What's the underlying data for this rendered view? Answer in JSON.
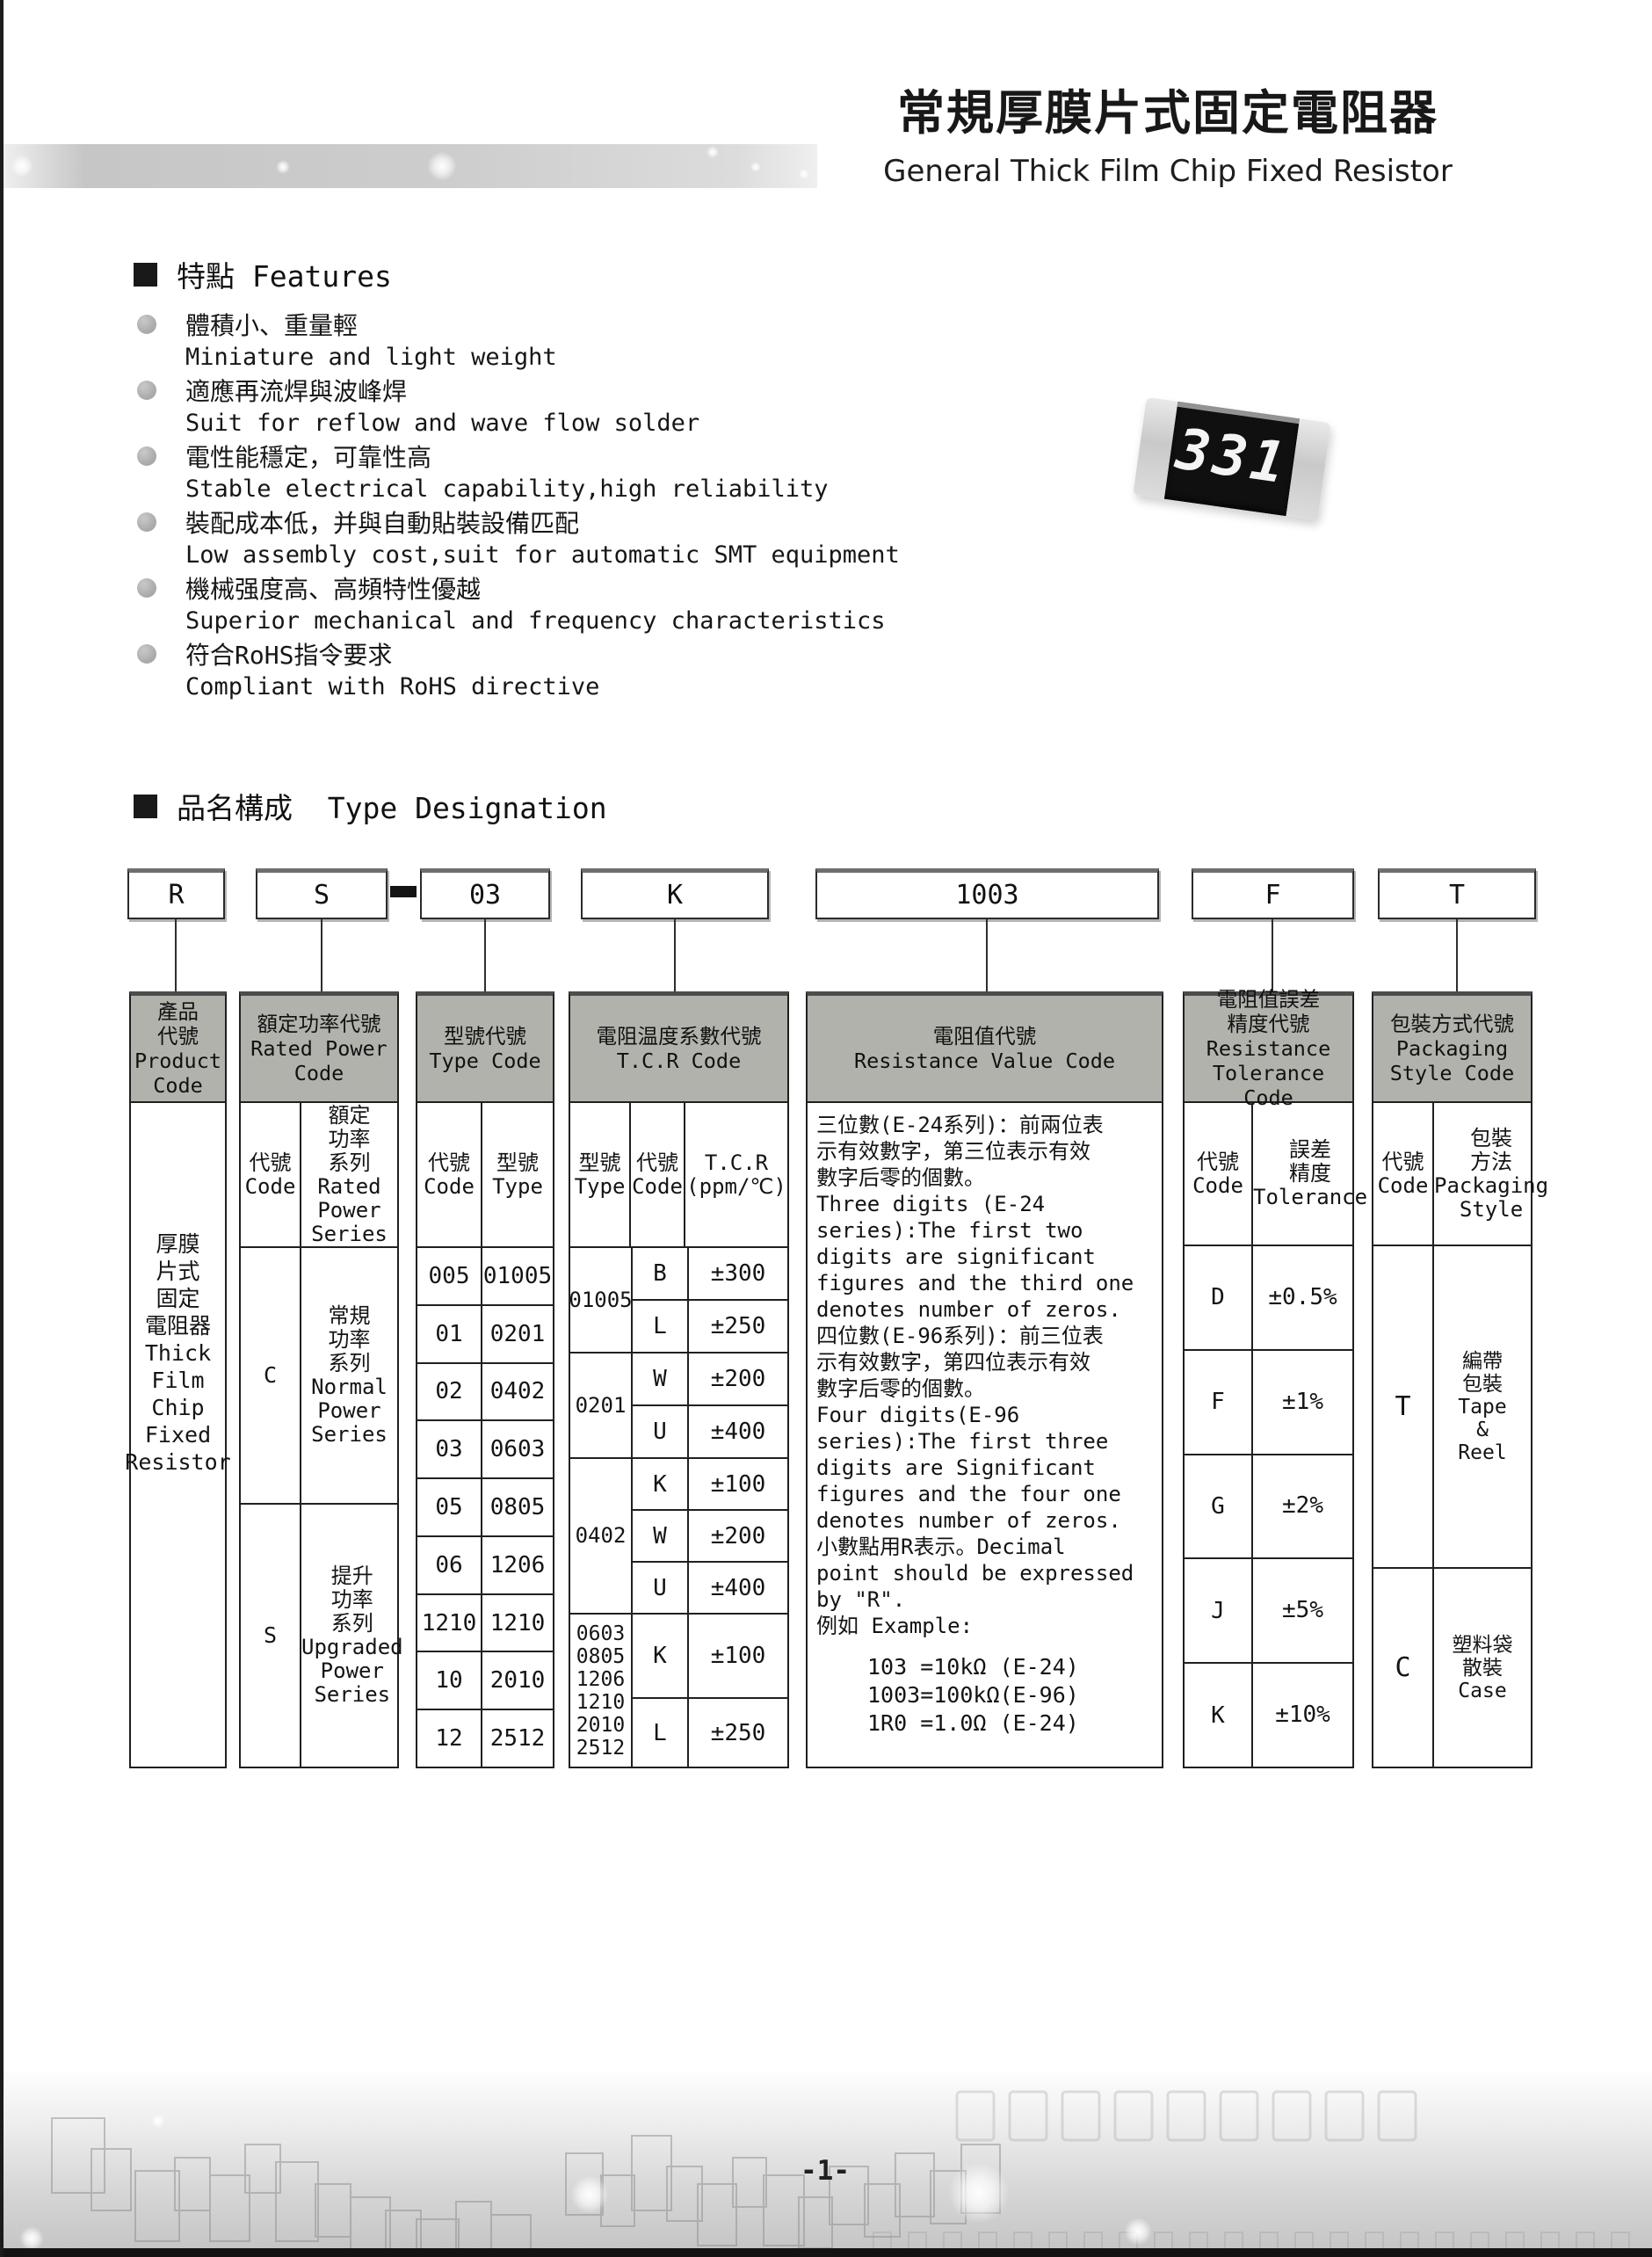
{
  "header": {
    "title_zh": "常規厚膜片式固定電阻器",
    "title_en": "General Thick Film Chip Fixed Resistor"
  },
  "features": {
    "heading": "特點 Features",
    "items": [
      {
        "zh": "體積小、重量輕",
        "en": "Miniature and light weight"
      },
      {
        "zh": "適應再流焊與波峰焊",
        "en": "Suit for reflow and wave flow solder"
      },
      {
        "zh": "電性能穩定，可靠性高",
        "en": "Stable electrical capability,high reliability"
      },
      {
        "zh": "裝配成本低，并與自動貼裝設備匹配",
        "en": "Low assembly cost,suit for automatic SMT equipment"
      },
      {
        "zh": "機械强度高、高頻特性優越",
        "en": "Superior mechanical and frequency characteristics"
      },
      {
        "zh": "符合RoHS指令要求",
        "en": "Compliant with RoHS directive"
      }
    ]
  },
  "resistor": {
    "marking": "331"
  },
  "type_designation": {
    "heading": "品名構成  Type Designation",
    "codes": {
      "product": "R",
      "power": "S",
      "type": "03",
      "tcr": "K",
      "resistance": "1003",
      "tolerance": "F",
      "packaging": "T"
    }
  },
  "table": {
    "product": {
      "header": "產品\n代號\nProduct\nCode",
      "body": "厚膜\n片式\n固定\n電阻器\nThick\nFilm\nChip\nFixed\nResistor"
    },
    "power": {
      "header": "額定功率代號\nRated Power\nCode",
      "col_code": "代號\nCode",
      "col_series": "額定\n功率\n系列\nRated\nPower\nSeries",
      "rows": [
        {
          "code": "C",
          "series": "常規\n功率\n系列\nNormal\nPower\nSeries"
        },
        {
          "code": "S",
          "series": "提升\n功率\n系列\nUpgraded\nPower\nSeries"
        }
      ]
    },
    "type": {
      "header": "型號代號\nType Code",
      "col_code": "代號\nCode",
      "col_type": "型號\nType",
      "rows": [
        [
          "005",
          "01005"
        ],
        [
          "01",
          "0201"
        ],
        [
          "02",
          "0402"
        ],
        [
          "03",
          "0603"
        ],
        [
          "05",
          "0805"
        ],
        [
          "06",
          "1206"
        ],
        [
          "1210",
          "1210"
        ],
        [
          "10",
          "2010"
        ],
        [
          "12",
          "2512"
        ]
      ]
    },
    "tcr": {
      "header": "電阻温度系數代號\nT.C.R Code",
      "col_type": "型號\nType",
      "col_code": "代號\nCode",
      "col_tcr": "T.C.R\n(ppm/℃)",
      "groups": [
        {
          "type": "01005",
          "rows": [
            [
              "B",
              "±300"
            ],
            [
              "L",
              "±250"
            ]
          ]
        },
        {
          "type": "0201",
          "rows": [
            [
              "W",
              "±200"
            ],
            [
              "U",
              "±400"
            ]
          ]
        },
        {
          "type": "0402",
          "rows": [
            [
              "K",
              "±100"
            ],
            [
              "W",
              "±200"
            ],
            [
              "U",
              "±400"
            ]
          ]
        },
        {
          "type": "0603\n0805\n1206\n1210\n2010\n2512",
          "rows": [
            [
              "K",
              "±100"
            ],
            [
              "L",
              "±250"
            ]
          ]
        }
      ]
    },
    "resistance": {
      "header": "電阻值代號\nResistance Value Code",
      "body": "三位數(E-24系列)：前兩位表\n示有效數字，第三位表示有效\n數字后零的個數。\nThree digits (E-24\nseries):The first two\ndigits are significant\nfigures and the third one\ndenotes number of zeros.\n四位數(E-96系列)：前三位表\n示有效數字，第四位表示有效\n數字后零的個數。\nFour digits(E-96\nseries):The first three\ndigits are Significant\nfigures and the four one\ndenotes number of zeros.\n小數點用R表示。Decimal\npoint should be expressed\nby \"R\".\n例如 Example:",
      "examples": "103 =10kΩ (E-24)\n1003=100kΩ(E-96)\n1R0 =1.0Ω  (E-24)"
    },
    "tolerance": {
      "header": "電阻值誤差\n精度代號\nResistance\nTolerance Code",
      "col_code": "代號\nCode",
      "col_tol": "誤差\n精度\nTolerance",
      "rows": [
        [
          "D",
          "±0.5%"
        ],
        [
          "F",
          "±1%"
        ],
        [
          "G",
          "±2%"
        ],
        [
          "J",
          "±5%"
        ],
        [
          "K",
          "±10%"
        ]
      ]
    },
    "packaging": {
      "header": "包裝方式代號\nPackaging\nStyle Code",
      "col_code": "代號\nCode",
      "col_style": "包裝\n方法\nPackaging\nStyle",
      "rows": [
        {
          "code": "T",
          "style": "編帶\n包裝\nTape\n&\nReel"
        },
        {
          "code": "C",
          "style": "塑料袋\n散裝\nCase"
        }
      ]
    }
  },
  "page": {
    "number": "-1-"
  }
}
